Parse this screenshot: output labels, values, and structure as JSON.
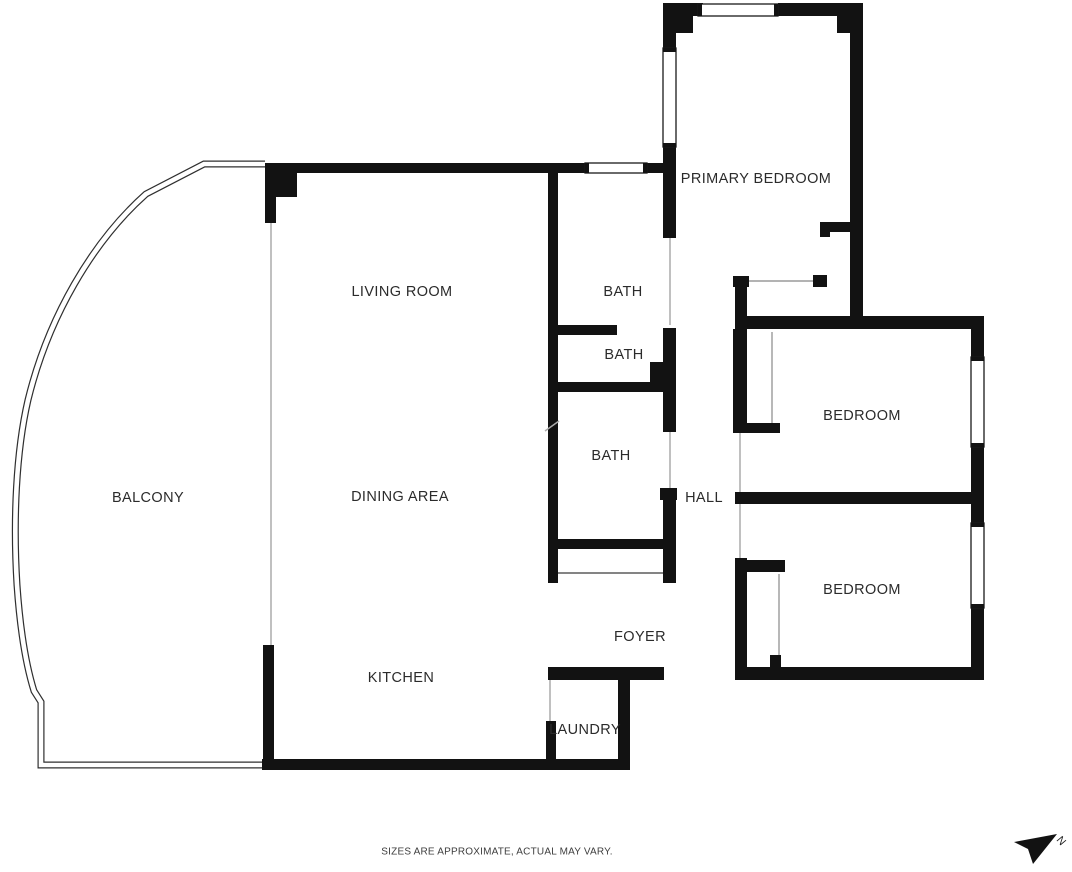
{
  "plan": {
    "type": "apartment-floor-plan",
    "wall_color": "#121212",
    "background_color": "#ffffff",
    "rooms": [
      {
        "label": "BALCONY"
      },
      {
        "label": "LIVING ROOM"
      },
      {
        "label": "DINING AREA"
      },
      {
        "label": "KITCHEN"
      },
      {
        "label": "PRIMARY BEDROOM"
      },
      {
        "label": "BATH"
      },
      {
        "label": "BATH"
      },
      {
        "label": "BATH"
      },
      {
        "label": "HALL"
      },
      {
        "label": "FOYER"
      },
      {
        "label": "LAUNDRY"
      },
      {
        "label": "BEDROOM"
      },
      {
        "label": "BEDROOM"
      }
    ],
    "window_count": 5
  },
  "footer": {
    "disclaimer": "SIZES ARE APPROXIMATE, ACTUAL MAY VARY."
  },
  "compass": {
    "letter": "N"
  }
}
